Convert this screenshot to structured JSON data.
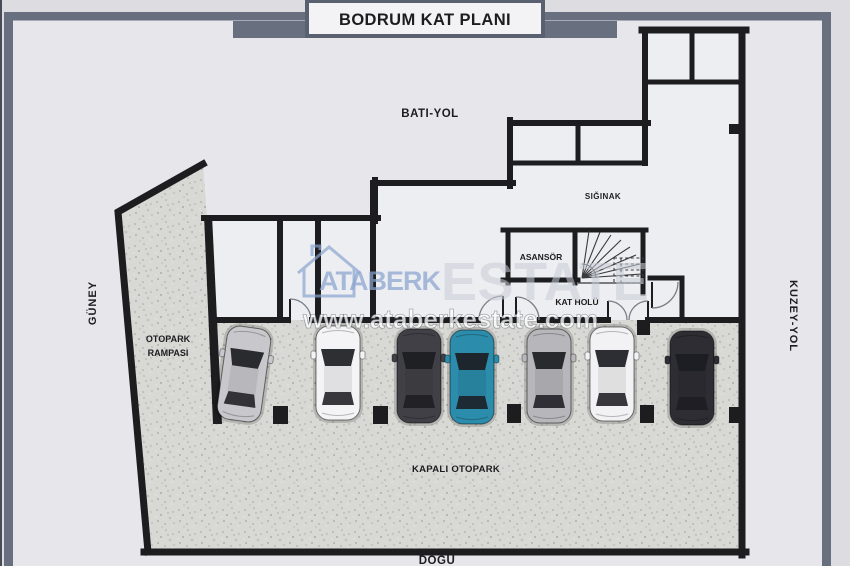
{
  "title": "BODRUM KAT PLANI",
  "roads": {
    "west": "BATI-YOL",
    "north": "KUZEY-YOL",
    "south": "GÜNEY",
    "east": "DOĞU"
  },
  "rooms": {
    "shelter": "SIĞINAK",
    "elevator": "ASANSÖR",
    "floor_hall": "KAT HOLÜ",
    "ramp_line1": "OTOPARK",
    "ramp_line2": "RAMPASI",
    "indoor_parking": "KAPALI OTOPARK"
  },
  "watermark": {
    "brand": "ATABERK",
    "brand_suffix": "ESTATE",
    "url": "www.ataberkestate.com"
  },
  "cars": [
    {
      "name": "silver-sports-car",
      "color": "#c8c8cc"
    },
    {
      "name": "white-sedan",
      "color": "#f4f4f6"
    },
    {
      "name": "dark-gray-sedan",
      "color": "#404046"
    },
    {
      "name": "teal-hatchback",
      "color": "#2b8cab"
    },
    {
      "name": "silver-suv",
      "color": "#b7b7bb"
    },
    {
      "name": "white-sedan-2",
      "color": "#f2f2f4"
    },
    {
      "name": "black-sedan",
      "color": "#2d2d33"
    }
  ],
  "colors": {
    "wall": "#1d1d20",
    "frame": "#68707f",
    "title_border": "#596070",
    "watermark_accent": "#8aa4cf",
    "watermark_secondary": "#c9cdd6",
    "floor": "#d8d8d5",
    "background": "#e6e6eb"
  }
}
